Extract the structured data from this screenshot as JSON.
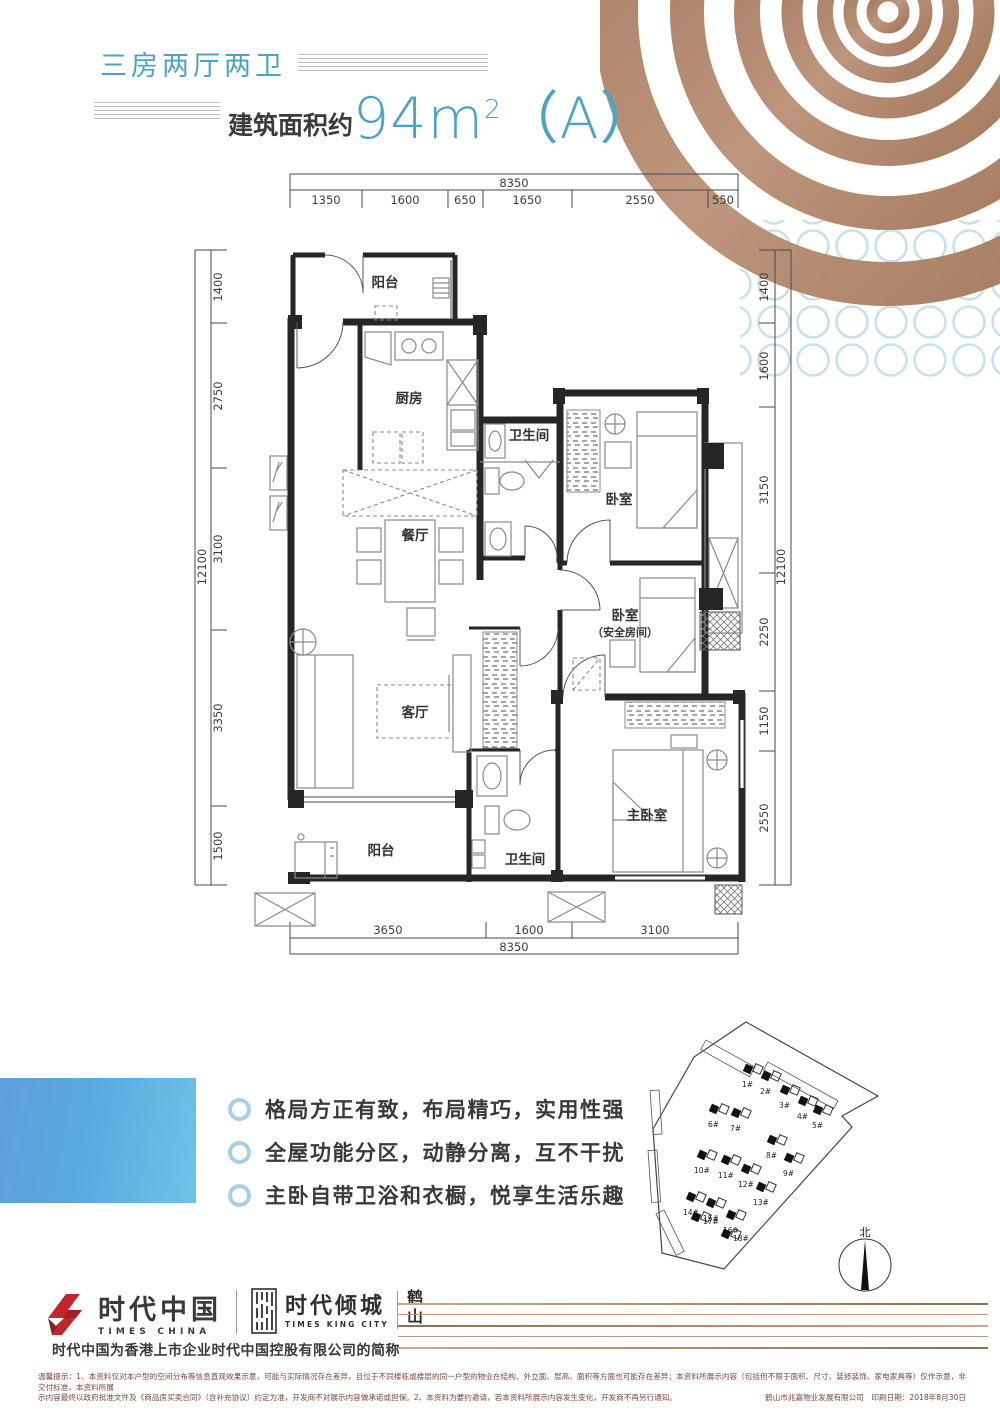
{
  "header": {
    "subtitle": "三房两厅两卫",
    "area_label": "建筑面积约",
    "area_number": "94m",
    "area_exp": "2",
    "area_suffix": "（A）"
  },
  "floorplan": {
    "rooms": {
      "balcony_top": "阳台",
      "kitchen": "厨房",
      "bath1": "卫生间",
      "bedroom1": "卧室",
      "dining": "餐厅",
      "bedroom2": "卧室",
      "bedroom2_sub": "（安全房间）",
      "living": "客厅",
      "master": "主卧室",
      "bath2": "卫生间",
      "balcony_bottom": "阳台"
    },
    "dims": {
      "top_total": "8350",
      "top_segments": [
        "1350",
        "1600",
        "650",
        "1650",
        "2550",
        "550"
      ],
      "left_total": "12100",
      "left_segments": [
        "1400",
        "2750",
        "3100",
        "3350",
        "1500"
      ],
      "right_total": "12100",
      "right_segments": [
        "1400",
        "1600",
        "3150",
        "2250",
        "1150",
        "2550"
      ],
      "bottom_total": "8350",
      "bottom_segments": [
        "3650",
        "1600",
        "3100"
      ]
    }
  },
  "features": {
    "items": [
      "格局方正有致，布局精巧，实用性强",
      "全屋功能分区，动静分离，互不干扰",
      "主卧自带卫浴和衣橱，悦享生活乐趣"
    ]
  },
  "siteplan": {
    "north": "北",
    "buildings": [
      "1#",
      "2#",
      "3#",
      "4#",
      "5#",
      "6#",
      "7#",
      "8#",
      "9#",
      "10#",
      "11#",
      "12#",
      "13#",
      "14#",
      "15#",
      "16#",
      "17#",
      "18#"
    ]
  },
  "footer": {
    "brand1_cn": "时代中国",
    "brand1_en": "TIMES CHINA",
    "brand2_cn": "时代倾城",
    "brand2_en": "TIMES KING CITY",
    "brand2_region": "鹤山",
    "tagline": "时代中国为香港上市企业时代中国控股有限公司的简称",
    "disclaimer_line1": "温馨提示：1、本资料仅对本户型的空间分布等信息直观效果示意，可能与实际情况存在差异，且位于不同楼栋或楼层的同一户型的物业在结构、外立面、层高、面积等方面也可能存在差异；本资料所展示内容（包括但不限于面积、尺寸、装修装饰、家电家具等）仅作示意，非交付标准，本资料所展",
    "disclaimer_line2": "示内容最终以政府批准文件及《商品房买卖合同》（含补充协议）约定为准，开发商不对展示内容做承诺或担保。2、本资料为要约邀请，若本资料所展示内容发生变化，开发商不再另行通知。",
    "disclaimer_company": "鹤山市兆嘉物业发展有限公司　印刷日期：2018年8月30日"
  }
}
